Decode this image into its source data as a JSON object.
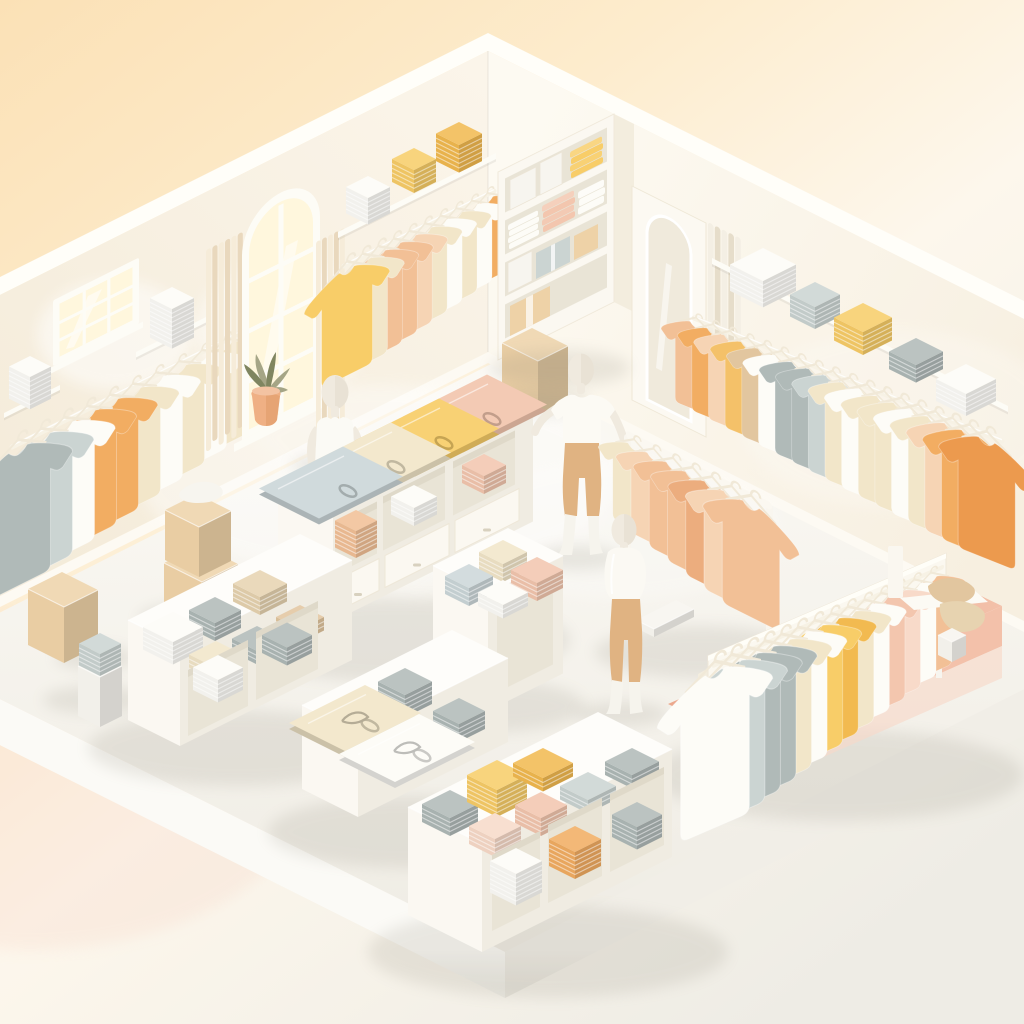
{
  "meta": {
    "type": "3d-isometric-illustration",
    "subject": "Pastel clothing store interior with wall racks, display tables, folded garment stacks, mannequins and boxes",
    "visible_text": "none"
  },
  "palette": {
    "bg0": "#fbe1b6",
    "bg1": "#fdeccd",
    "bg2": "#fdf7ec",
    "bg3": "#eeece5",
    "wallL0": "#f4ebd9",
    "wallL1": "#fbf5ea",
    "wallR0": "#fdfaf2",
    "wallR1": "#f7efe0",
    "rim": "#fffef9",
    "floor0": "#fbf9f4",
    "floor1": "#efece4",
    "slabL0": "#fbfaf6",
    "slabL1": "#e8e6de",
    "slabR0": "#f1eee7",
    "slabR1": "#e2dfd6",
    "base": "#fdfaf3",
    "glow0": "#fff7dd",
    "glow1": "#ffeec6",
    "frame": "#fdfcf6",
    "curA": "#e9d8bd",
    "curB": "#f6ecd9",
    "curC": "#f4efe4",
    "curD": "#e6ddca",
    "terr": "#efb084",
    "terrD": "#d89055",
    "leaf": "#a5a586",
    "leafD": "#7f8560",
    "railC": "#f7f2e5",
    "hangerC": "#f1e9d8",
    "white": "#fdfcf7",
    "cream": "#f2e6c9",
    "beige": "#e7d3b0",
    "yellow": "#f8cd68",
    "yellowDeep": "#f2ba50",
    "yellowOrange": "#f4c169",
    "orange": "#f2ad62",
    "orangeDeep": "#ec9a4e",
    "peach": "#f2c096",
    "peachLight": "#f6d4b4",
    "peachDeep": "#ecad7e",
    "pink": "#f3c6ae",
    "pinkLight": "#f8dac9",
    "gray": "#b0bab8",
    "grayLight": "#cbd4d2",
    "grayBlue": "#ccd7d9",
    "tan": "#e2c69f",
    "tanLight": "#edddc0",
    "mann": "#f0eadf",
    "mannS": "#dcd3c2",
    "pants": "#e0b382",
    "boots": "#f6f4ed",
    "boxC": "#eed2a7",
    "boxCL": "#f6e2c0",
    "boxW": "#f7f5ef",
    "pink0": "#eca88d",
    "pink1": "#f3c1aa",
    "pink2": "#f7d8c9",
    "mirror0": "#f0eadc",
    "mirror1": "#faf7f0",
    "panel": "#fcf9f2",
    "shadow": "#8e897a",
    "unitFace": "#fbf8f1",
    "unitSide": "#f3edde",
    "inner": "#e9e4d6",
    "innerD": "#d8d2c0"
  },
  "scene": {
    "background": {
      "gradient": [
        "bg0",
        "bg1",
        "bg2",
        "bg3"
      ]
    },
    "left_wall": {
      "grid_window": {
        "cols": 3,
        "rows": 3
      },
      "small_shelf_stack": {
        "color": "white",
        "layers": 7
      },
      "upper_shelf_stack": {
        "color": "white",
        "layers": 9
      },
      "rack_shirts": [
        "gray",
        "grayLight",
        "white",
        "orange",
        "orange",
        "cream",
        "white",
        "cream",
        "white",
        "cream"
      ],
      "arched_window": {
        "plant": {
          "pot": "terr",
          "leaves": "leaf"
        }
      },
      "curtains": {
        "left": [
          "curB",
          "curA"
        ],
        "right": [
          "curB",
          "curA"
        ]
      }
    },
    "back_wall": {
      "shelf_stacks": [
        {
          "color": "white",
          "layers": 6
        },
        {
          "color": "yellow",
          "layers": 5
        },
        {
          "color": "yellowDeep",
          "layers": 6
        }
      ],
      "rack_shirts": [
        "yellow",
        "cream",
        "peach",
        "peach",
        "peachLight",
        "cream",
        "white",
        "cream",
        "white",
        "orange"
      ]
    },
    "shelving_unit": {
      "shelves": [
        {
          "items": [
            {
              "kind": "box",
              "color": "boxW"
            },
            {
              "kind": "box",
              "color": "boxW"
            },
            {
              "kind": "stack",
              "color": "yellow",
              "layers": 4
            }
          ]
        },
        {
          "items": [
            {
              "kind": "stack",
              "color": "white",
              "layers": 4
            },
            {
              "kind": "stack",
              "color": "pink",
              "layers": 4
            },
            {
              "kind": "stack",
              "color": "white",
              "layers": 3
            }
          ]
        },
        {
          "items": [
            {
              "kind": "box",
              "color": "boxW"
            },
            {
              "kind": "package",
              "color": "grayLight"
            },
            {
              "kind": "box",
              "color": "boxC"
            }
          ]
        },
        {
          "items": [
            {
              "kind": "box",
              "color": "boxC"
            }
          ]
        }
      ]
    },
    "mirror": {
      "shape": "arched-full-length"
    },
    "corner_curtain": [
      "curC",
      "curD"
    ],
    "right_wall": {
      "shelf_stacks": [
        {
          "color": "white",
          "layers": 6
        },
        {
          "color": "grayLight",
          "layers": 5
        },
        {
          "color": "yellow",
          "layers": 5
        },
        {
          "color": "gray",
          "layers": 4
        },
        {
          "color": "white",
          "layers": 5
        }
      ],
      "rack_shirts": [
        "peach",
        "orange",
        "peachLight",
        "yellowOrange",
        "tan",
        "white",
        "gray",
        "gray",
        "grayLight",
        "cream",
        "white",
        "cream",
        "cream",
        "white",
        "cream",
        "peachLight",
        "orange",
        "orangeDeep"
      ]
    },
    "rack_a": {
      "shirts": [
        "cream",
        "peachLight",
        "peach",
        "peach",
        "peachDeep",
        "peachLight",
        "peach"
      ]
    },
    "rack_b": {
      "shirts": [
        "white",
        "grayLight",
        "gray",
        "gray",
        "cream",
        "white",
        "yellow",
        "yellowDeep",
        "cream",
        "white",
        "pink",
        "pinkLight",
        "white",
        "peach"
      ],
      "platform": [
        "pink0",
        "pink1",
        "pink2"
      ]
    },
    "tables": {
      "table_1": {
        "top_items": [
          "pink",
          "yellow",
          "cream",
          "grayBlue"
        ],
        "cubby_stacks": [
          "pink",
          "white",
          "peach"
        ],
        "drawers": 3
      },
      "cube_table": {
        "top_items": [
          "cream",
          "pink",
          "grayBlue",
          "white"
        ]
      },
      "table_3": {
        "top_stacks": [
          "beige",
          "tan",
          "gray",
          "white",
          "gray",
          "cream"
        ],
        "cubby_stacks": [
          "gray",
          "white"
        ]
      },
      "table_4": {
        "top_stacks": [
          "gray",
          "gray"
        ],
        "flat_shirts": [
          "cream",
          "white"
        ]
      },
      "table_5": {
        "top_stacks": [
          "gray",
          "yellow",
          "yellowDeep",
          "grayLight",
          "gray",
          "pink",
          "pinkLight"
        ],
        "cubby_stacks": [
          "gray",
          "orange",
          "white"
        ]
      }
    },
    "mannequins": [
      {
        "id": "mannequin-1",
        "visible": "upper body behind table",
        "outfit": "white tank top"
      },
      {
        "id": "mannequin-2",
        "pose": "arm extended toward rack",
        "outfit": "white tee, tan trousers, white boots"
      },
      {
        "id": "mannequin-3",
        "pose": "standing",
        "outfit": "white draped top, tan trousers"
      }
    ],
    "boxes": [
      {
        "id": "box-stack",
        "color": "boxC",
        "count": 2,
        "topper": "white cloth"
      },
      {
        "id": "single-box",
        "color": "boxC",
        "tape": true
      },
      {
        "id": "white-pedestal",
        "color": "boxW",
        "topper": {
          "kind": "stack",
          "color": "grayLight",
          "layers": 5
        }
      },
      {
        "id": "corner-box",
        "color": "boxC",
        "tape": true
      }
    ],
    "display_stand": {
      "kind": "folded garments on wall ledge",
      "items": [
        "tan",
        "beige"
      ]
    }
  }
}
